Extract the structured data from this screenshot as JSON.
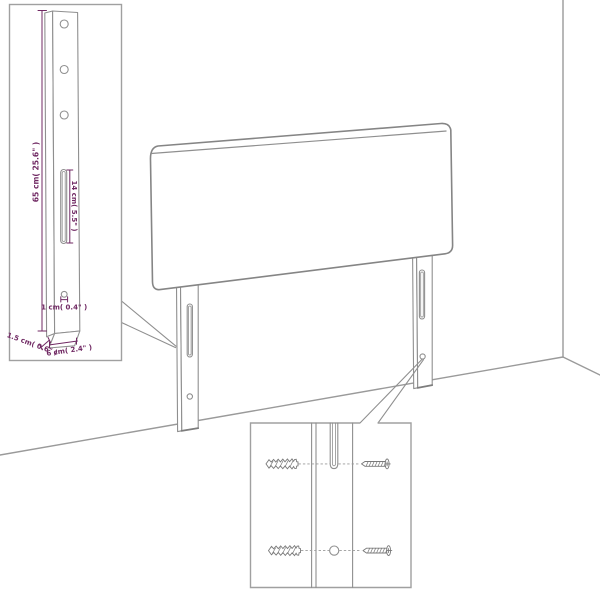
{
  "colors": {
    "line_gray": "#8f8f8f",
    "wall_gray": "#9a9a9a",
    "dimension_purple": "#702963",
    "background": "#ffffff"
  },
  "dimensions": {
    "leg_height": "65 cm( 25.6\" )",
    "slot_length": "14 cm( 5.5\" )",
    "hole_diameter": "1 cm( 0.4\" )",
    "leg_thickness": "1.5 cm( 0.6\" )",
    "leg_width": "6 cm( 2.4\" )"
  }
}
